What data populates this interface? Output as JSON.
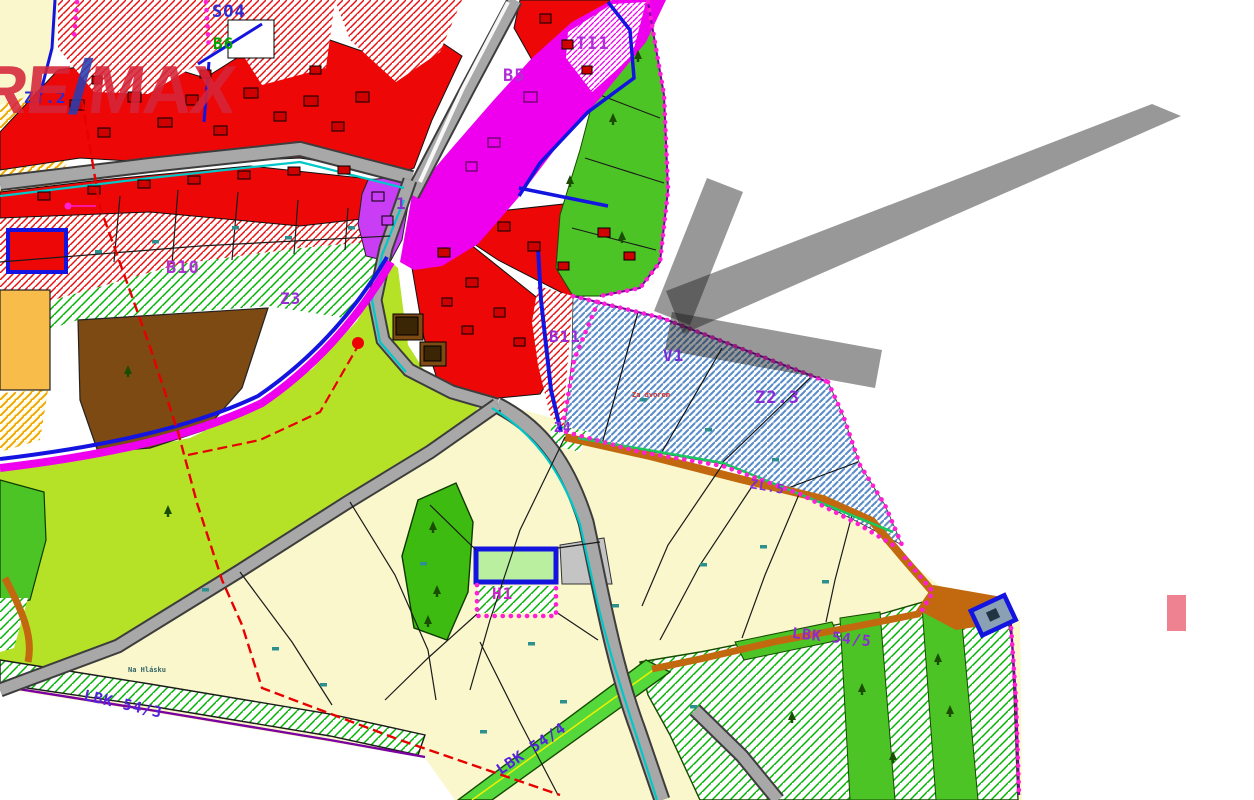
{
  "watermark": {
    "part1": "RE",
    "slash": "/",
    "part2": "MAX",
    "color_primary": "#d5253a",
    "color_slash": "#2a3db0"
  },
  "map": {
    "labels": {
      "so4": {
        "text": "SO4",
        "color": "#2b2bd6"
      },
      "b6": {
        "text": "B6",
        "color": "#00a400"
      },
      "ti1": {
        "text": "TI1",
        "color": "#b02fd6"
      },
      "b5": {
        "text": "B5",
        "color": "#b02fd6"
      },
      "zt2": {
        "text": "ZT.2",
        "color": "#2b2bd6"
      },
      "one": {
        "text": "1",
        "color": "#8a2bd6"
      },
      "b10": {
        "text": "B10",
        "color": "#b02fd6"
      },
      "z3": {
        "text": "Z3",
        "color": "#9a2bd6"
      },
      "b11": {
        "text": "B11",
        "color": "#9a2bd6"
      },
      "v1": {
        "text": "V1",
        "color": "#7a2bd6"
      },
      "z23": {
        "text": "Z2.3",
        "color": "#8a2bd6"
      },
      "z4": {
        "text": "Z4",
        "color": "#8a2bd6"
      },
      "zl5": {
        "text": "ZL.5",
        "color": "#8a2bd6"
      },
      "h1": {
        "text": "H1",
        "color": "#cc22cc"
      },
      "lbk543": {
        "text": "LBK 54/3",
        "color": "#5522dd"
      },
      "lbk544": {
        "text": "LBK 54/4",
        "color": "#5522dd"
      },
      "lbk545": {
        "text": "LBK 54/5",
        "color": "#8a2bd6"
      },
      "nahlasku": {
        "text": "Na Hlásku",
        "color": "#336666"
      },
      "zadvorem": {
        "text": "Za dvorem",
        "color": "#cc3333"
      }
    },
    "palette": {
      "built_up_red": "#ee0707",
      "development_hatch_red": "#e81010",
      "green_area": "#4dc426",
      "meadow_chartreuse": "#b5e227",
      "fields_pale_yellow": "#faf7cd",
      "farm_brown": "#7c4a12",
      "orchard_orange": "#f7bc4a",
      "corridor_magenta": "#ee00ee",
      "civic_purple": "#c93df5",
      "parcel_hatch_blue": "#5b8ec9",
      "road_gray": "#a8a8a8",
      "road_orange": "#c2690f",
      "boundary_blue": "#1414e0",
      "boundary_dots_magenta": "#ff1fd4",
      "power_line_red": "#e80000",
      "water_cyan": "#00c8c8"
    },
    "annotations": {
      "arrow": {
        "meaning": "points-to-offered-parcel",
        "direction": "down-left",
        "color": "#1a1a1a",
        "opacity": 0.45
      },
      "highlight_rect": {
        "color": "#ee8291"
      }
    }
  }
}
